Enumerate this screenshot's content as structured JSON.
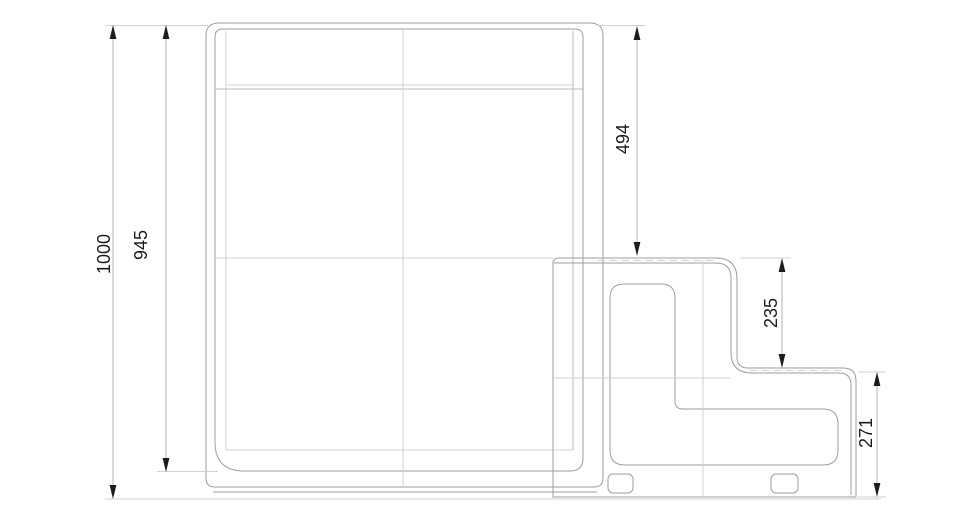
{
  "drawing": {
    "title": "side-elevation-technical-drawing",
    "units": "mm",
    "dimensions": {
      "overall_height": "1000",
      "body_height": "945",
      "top_to_upper_step": "494",
      "step_rise": "235",
      "lower_step_height": "271"
    },
    "colors": {
      "background": "#ffffff",
      "line_main": "#9e9e9e",
      "line_light": "#d2d2d2",
      "dimension_line": "#b3b3b3",
      "dimension_text": "#1c1c1c",
      "arrowhead": "#1c1c1c"
    }
  }
}
